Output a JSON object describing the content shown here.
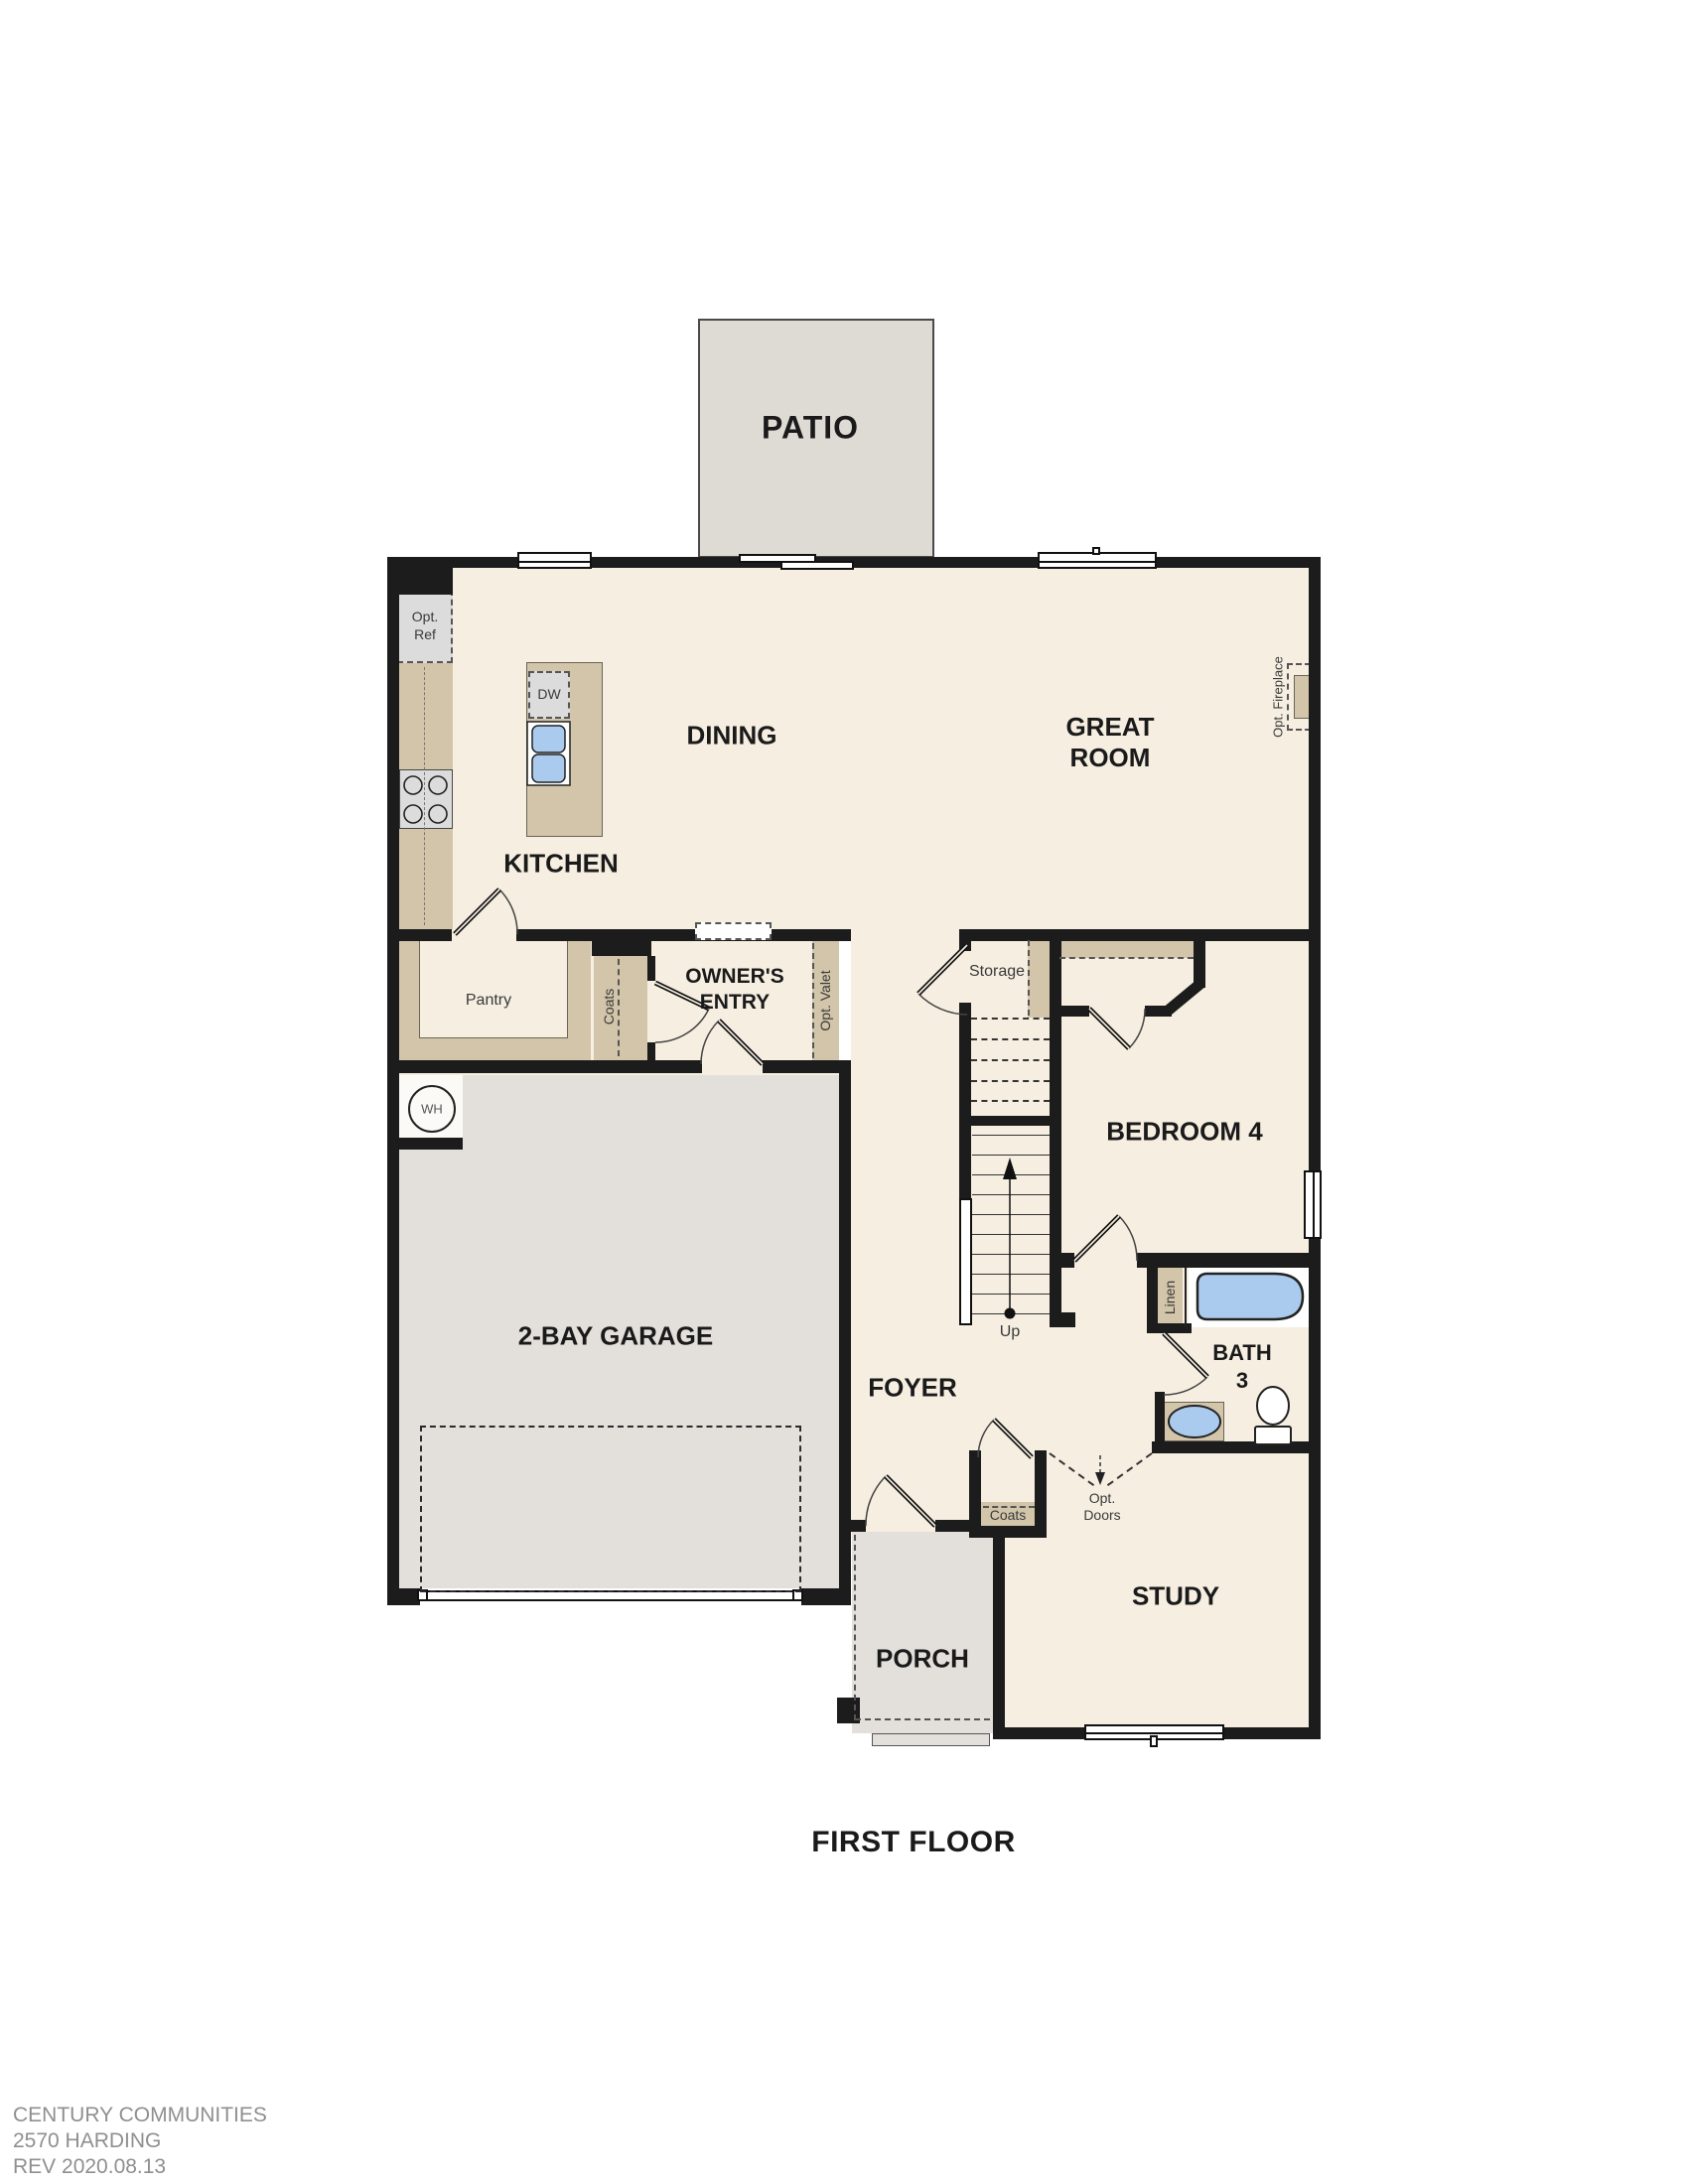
{
  "title": "FIRST FLOOR",
  "rooms": {
    "patio": "PATIO",
    "dining": "DINING",
    "kitchen": "KITCHEN",
    "great_room_line1": "GREAT",
    "great_room_line2": "ROOM",
    "owners_entry_line1": "OWNER'S",
    "owners_entry_line2": "ENTRY",
    "bedroom4": "BEDROOM 4",
    "bath_line1": "BATH",
    "bath_line2": "3",
    "garage": "2-BAY GARAGE",
    "foyer": "FOYER",
    "study": "STUDY",
    "porch": "PORCH"
  },
  "fixtures": {
    "opt_ref_line1": "Opt.",
    "opt_ref_line2": "Ref",
    "dw": "DW",
    "pantry": "Pantry",
    "coats_owners": "Coats",
    "opt_valet": "Opt. Valet",
    "opt_fireplace": "Opt. Fireplace",
    "storage": "Storage",
    "up": "Up",
    "wh": "WH",
    "linen": "Linen",
    "coats_foyer": "Coats",
    "opt_doors_line1": "Opt.",
    "opt_doors_line2": "Doors"
  },
  "footer": {
    "line1": "CENTURY COMMUNITIES",
    "line2": "2570 HARDING",
    "line3": "REV 2020.08.13"
  },
  "colors": {
    "wall": "#1c1c1c",
    "floor": "#f5eee1",
    "tan": "#d2c5a9",
    "grayfloor": "#e3e0db",
    "graypatio": "#dedad4",
    "appliance": "#dcdcdc",
    "blue": "#aacbed",
    "footer": "#8f8f8f",
    "label": "#1a1a1a"
  }
}
